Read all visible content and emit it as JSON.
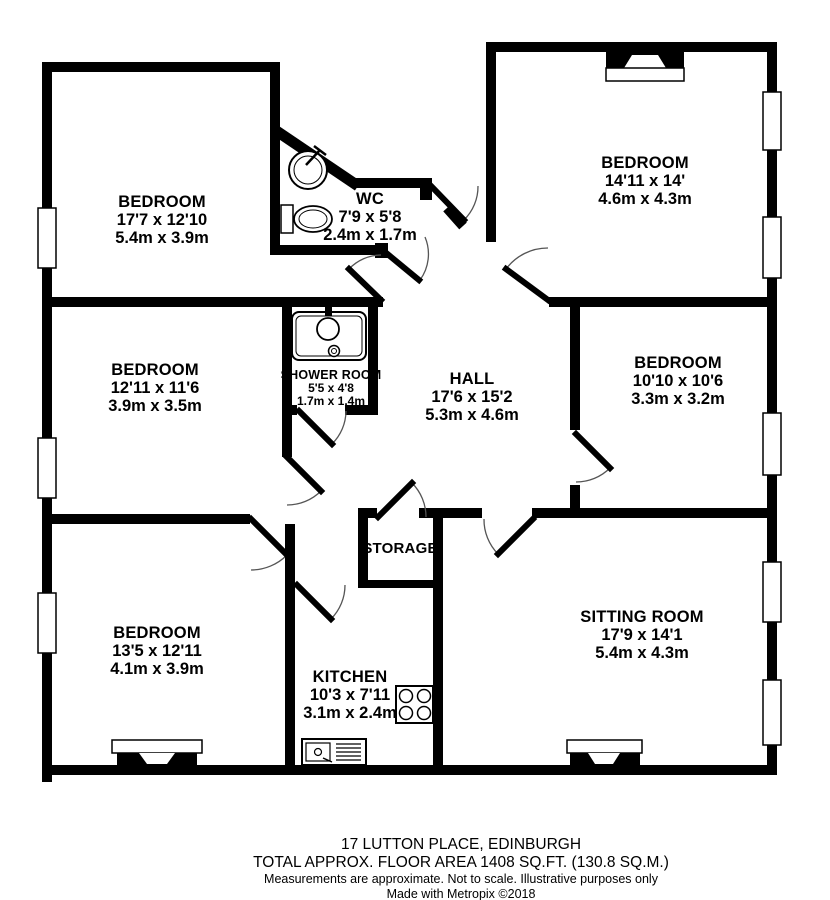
{
  "rooms": {
    "bedroom_tl": {
      "name": "BEDROOM",
      "imperial": "17'7 x 12'10",
      "metric": "5.4m x 3.9m"
    },
    "wc": {
      "name": "WC",
      "imperial": "7'9 x 5'8",
      "metric": "2.4m x 1.7m"
    },
    "bedroom_tr": {
      "name": "BEDROOM",
      "imperial": "14'11 x 14'",
      "metric": "4.6m x 4.3m"
    },
    "bedroom_ml": {
      "name": "BEDROOM",
      "imperial": "12'11 x 11'6",
      "metric": "3.9m x 3.5m"
    },
    "shower": {
      "name": "SHOWER ROOM",
      "imperial": "5'5 x 4'8",
      "metric": "1.7m x 1.4m"
    },
    "hall": {
      "name": "HALL",
      "imperial": "17'6 x 15'2",
      "metric": "5.3m x 4.6m"
    },
    "bedroom_mr": {
      "name": "BEDROOM",
      "imperial": "10'10 x 10'6",
      "metric": "3.3m x 3.2m"
    },
    "bedroom_bl": {
      "name": "BEDROOM",
      "imperial": "13'5 x 12'11",
      "metric": "4.1m x 3.9m"
    },
    "storage": {
      "name": "STORAGE"
    },
    "kitchen": {
      "name": "KITCHEN",
      "imperial": "10'3 x 7'11",
      "metric": "3.1m x 2.4m"
    },
    "sitting": {
      "name": "SITTING ROOM",
      "imperial": "17'9 x 14'1",
      "metric": "5.4m x 4.3m"
    }
  },
  "footer": {
    "address": "17 LUTTON PLACE, EDINBURGH",
    "area": "TOTAL APPROX. FLOOR AREA 1408 SQ.FT. (130.8 SQ.M.)",
    "disclaimer": "Measurements are approximate.  Not to scale.  Illustrative purposes only",
    "credit": "Made with Metropix ©2018"
  },
  "colors": {
    "wall": "#000000",
    "background": "#ffffff",
    "door_arc": "#555555"
  }
}
